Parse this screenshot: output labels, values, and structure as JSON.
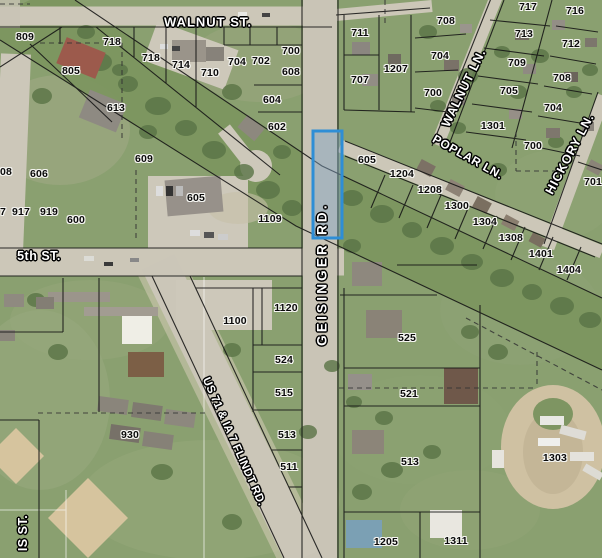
{
  "map": {
    "width": 602,
    "height": 558,
    "highlighted_parcel": {
      "x": 313,
      "y": 131,
      "w": 29,
      "h": 107,
      "stroke": "#2e8ed6",
      "fill": "rgba(128,164,196,0.45)"
    },
    "street_labels": [
      {
        "text": "WALNUT ST.",
        "x": 208,
        "y": 22,
        "rotate": 0,
        "size": 13,
        "ls": 1
      },
      {
        "text": "5th ST.",
        "x": 39,
        "y": 256,
        "rotate": 0,
        "size": 12.5,
        "ls": 0.5
      },
      {
        "text": "GEISINGER RD.",
        "x": 322,
        "y": 274,
        "rotate": -90,
        "size": 13.5,
        "ls": 3.2
      },
      {
        "text": "WALNUT LN.",
        "x": 464,
        "y": 88,
        "rotate": -64,
        "size": 12.5,
        "ls": 0.8
      },
      {
        "text": "POPLAR LN.",
        "x": 468,
        "y": 157,
        "rotate": 29,
        "size": 12,
        "ls": 0.6
      },
      {
        "text": "HICKORY LN.",
        "x": 570,
        "y": 154,
        "rotate": -62,
        "size": 12.5,
        "ls": 0.8
      },
      {
        "text": "US 71 & IA 7 FLINDT RD.",
        "x": 233,
        "y": 442,
        "rotate": 66,
        "size": 11.5,
        "ls": 0.2
      },
      {
        "text": "IS ST.",
        "x": 23,
        "y": 533,
        "rotate": -90,
        "size": 12.5,
        "ls": 0.5
      }
    ],
    "parcel_labels": [
      {
        "text": "809",
        "x": 25,
        "y": 37
      },
      {
        "text": "718",
        "x": 112,
        "y": 42
      },
      {
        "text": "718",
        "x": 151,
        "y": 58
      },
      {
        "text": "805",
        "x": 71,
        "y": 71
      },
      {
        "text": "714",
        "x": 181,
        "y": 65
      },
      {
        "text": "710",
        "x": 210,
        "y": 73
      },
      {
        "text": "704",
        "x": 237,
        "y": 62
      },
      {
        "text": "702",
        "x": 261,
        "y": 61
      },
      {
        "text": "700",
        "x": 291,
        "y": 51
      },
      {
        "text": "608",
        "x": 291,
        "y": 72
      },
      {
        "text": "604",
        "x": 272,
        "y": 100
      },
      {
        "text": "602",
        "x": 277,
        "y": 127
      },
      {
        "text": "613",
        "x": 116,
        "y": 108
      },
      {
        "text": "609",
        "x": 144,
        "y": 159
      },
      {
        "text": "606",
        "x": 39,
        "y": 174
      },
      {
        "text": "08",
        "x": 6,
        "y": 172
      },
      {
        "text": "7",
        "x": 3,
        "y": 212
      },
      {
        "text": "917",
        "x": 21,
        "y": 212
      },
      {
        "text": "919",
        "x": 49,
        "y": 212
      },
      {
        "text": "600",
        "x": 76,
        "y": 220
      },
      {
        "text": "605",
        "x": 196,
        "y": 198
      },
      {
        "text": "1109",
        "x": 270,
        "y": 219
      },
      {
        "text": "711",
        "x": 360,
        "y": 33
      },
      {
        "text": "707",
        "x": 360,
        "y": 80
      },
      {
        "text": "1207",
        "x": 396,
        "y": 69
      },
      {
        "text": "708",
        "x": 446,
        "y": 21
      },
      {
        "text": "704",
        "x": 440,
        "y": 56
      },
      {
        "text": "700",
        "x": 433,
        "y": 93
      },
      {
        "text": "605",
        "x": 367,
        "y": 160
      },
      {
        "text": "717",
        "x": 528,
        "y": 7
      },
      {
        "text": "716",
        "x": 575,
        "y": 11
      },
      {
        "text": "713",
        "x": 524,
        "y": 34
      },
      {
        "text": "712",
        "x": 571,
        "y": 44
      },
      {
        "text": "709",
        "x": 517,
        "y": 63
      },
      {
        "text": "708",
        "x": 562,
        "y": 78
      },
      {
        "text": "705",
        "x": 509,
        "y": 91
      },
      {
        "text": "704",
        "x": 553,
        "y": 108
      },
      {
        "text": "1301",
        "x": 493,
        "y": 126
      },
      {
        "text": "700",
        "x": 533,
        "y": 146
      },
      {
        "text": "701",
        "x": 593,
        "y": 182
      },
      {
        "text": "1204",
        "x": 402,
        "y": 174
      },
      {
        "text": "1208",
        "x": 430,
        "y": 190
      },
      {
        "text": "1300",
        "x": 457,
        "y": 206
      },
      {
        "text": "1304",
        "x": 485,
        "y": 222
      },
      {
        "text": "1308",
        "x": 511,
        "y": 238
      },
      {
        "text": "1401",
        "x": 541,
        "y": 254
      },
      {
        "text": "1404",
        "x": 569,
        "y": 270
      },
      {
        "text": "1120",
        "x": 286,
        "y": 308
      },
      {
        "text": "1100",
        "x": 235,
        "y": 321
      },
      {
        "text": "524",
        "x": 284,
        "y": 360
      },
      {
        "text": "515",
        "x": 284,
        "y": 393
      },
      {
        "text": "513",
        "x": 287,
        "y": 435
      },
      {
        "text": "511",
        "x": 289,
        "y": 467
      },
      {
        "text": "930",
        "x": 130,
        "y": 435
      },
      {
        "text": "525",
        "x": 407,
        "y": 338
      },
      {
        "text": "521",
        "x": 409,
        "y": 394
      },
      {
        "text": "513",
        "x": 410,
        "y": 462
      },
      {
        "text": "1303",
        "x": 555,
        "y": 458
      },
      {
        "text": "1205",
        "x": 386,
        "y": 542
      },
      {
        "text": "1311",
        "x": 456,
        "y": 541
      }
    ]
  }
}
